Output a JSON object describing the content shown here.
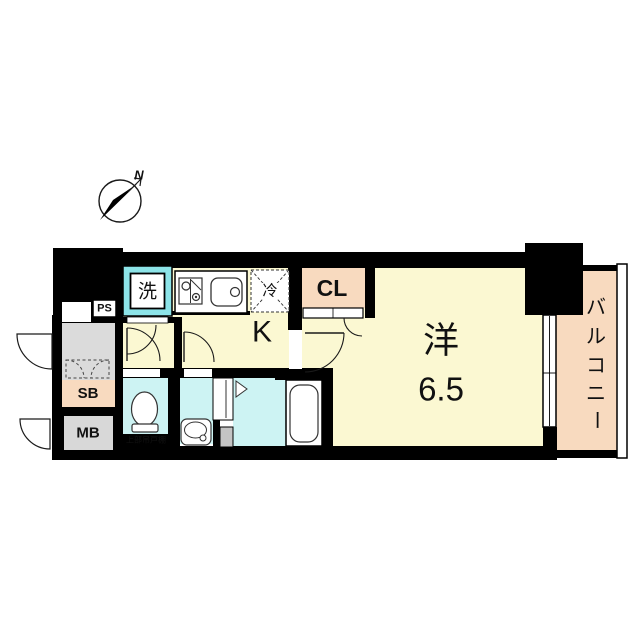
{
  "diagram_type": "apartment-floor-plan",
  "compass": {
    "north_label": "N"
  },
  "labels": {
    "pipe_space": "PS",
    "shoe_box": "SB",
    "meter_box": "MB",
    "washing_machine": "洗",
    "refrigerator": "冷",
    "kitchen": "K",
    "closet": "CL",
    "western_room": "洋",
    "western_room_size": "6.5",
    "balcony": "バルコニー",
    "balcony_chars": [
      "バ",
      "ル",
      "コ",
      "ニ",
      "ー"
    ],
    "upper_cabinet_note": "上部吊戸棚"
  },
  "colors": {
    "room_yellow": "#fbf8d2",
    "wet_area_cyan": "#cdf3f3",
    "washer_frame_cyan": "#8de4e8",
    "accent_peach": "#f8dabf",
    "entrance_gray": "#dbdbdb",
    "meter_box_gray": "#d8d8d8",
    "fixture_gray": "#c4c4c4",
    "wall_black": "#000000",
    "line_dark": "#1a1a1a",
    "note_text_white": "#ffffff"
  }
}
